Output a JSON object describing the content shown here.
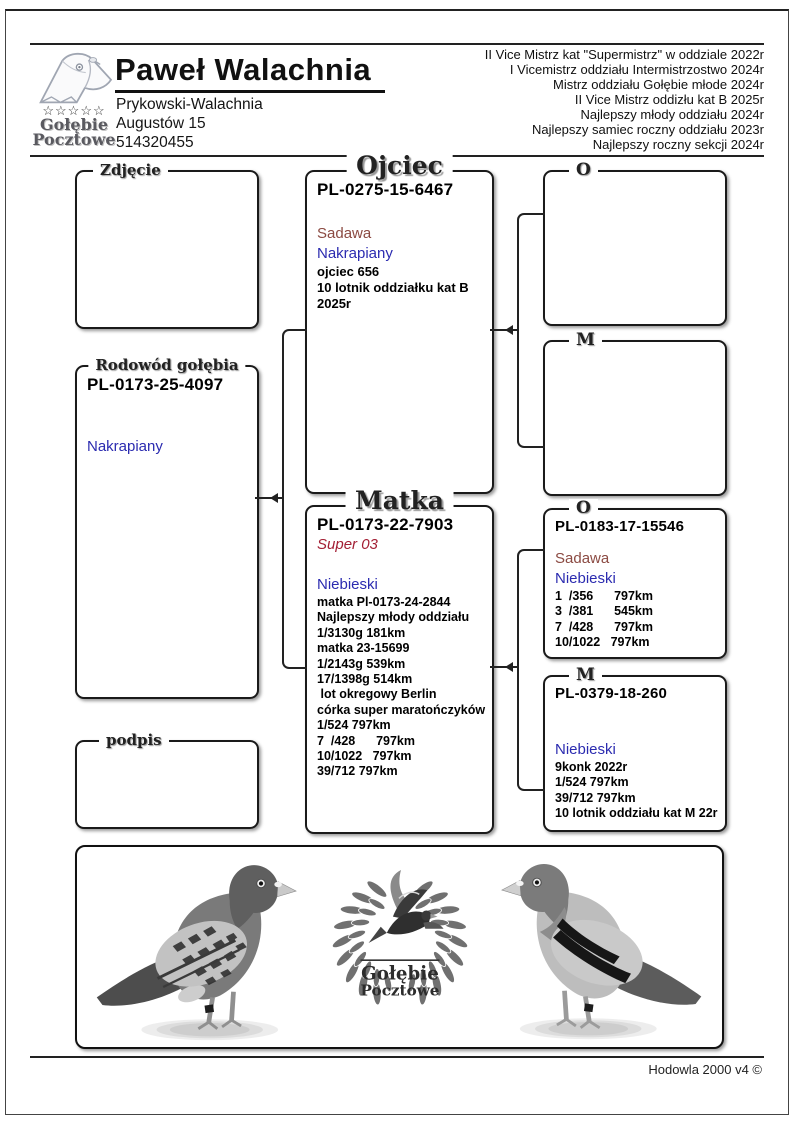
{
  "header": {
    "logo": {
      "icon": "pigeon-head-icon",
      "stars": "☆☆☆☆☆",
      "line1": "Gołębie",
      "line2": "Pocztowe"
    },
    "name": "Paweł Walachnia",
    "address_lines": [
      "Prykowski-Walachnia",
      "Augustów 15",
      "514320455"
    ],
    "achievements": [
      "II Vice Mistrz kat \"Supermistrz\" w oddziale 2022r",
      "I Vicemistrz oddziału Intermistrzostwo 2024r",
      "Mistrz oddziału Gołębie młode 2024r",
      "II Vice Mistrz oddizłu kat B 2025r",
      "Najlepszy młody oddziału 2024r",
      "Najlepszy samiec roczny oddziału 2023r",
      "Najlepszy roczny sekcji 2024r"
    ]
  },
  "pedigree": {
    "photo_box": {
      "legend": "Zdjęcie"
    },
    "main": {
      "legend": "Rodowód gołębia",
      "ring": "PL-0173-25-4097",
      "color": "Nakrapiany"
    },
    "signature_box": {
      "legend": "podpis"
    },
    "father": {
      "legend": "Ojciec",
      "ring": "PL-0275-15-6467",
      "strain": "Sadawa",
      "color": "Nakrapiany",
      "notes": [
        "ojciec 656",
        "10 lotnik oddziałku kat B",
        "2025r"
      ]
    },
    "mother": {
      "legend": "Matka",
      "ring": "PL-0173-22-7903",
      "name": "Super 03",
      "color": "Niebieski",
      "notes": [
        "matka Pl-0173-24-2844",
        "Najlepszy młody oddziału",
        "1/3130g 181km",
        "matka 23-15699",
        "1/2143g 539km",
        "17/1398g 514km",
        " lot okregowy Berlin",
        "córka super maratończyków",
        "1/524 797km",
        "7  /428      797km",
        "10/1022   797km",
        "39/712 797km"
      ]
    },
    "gp_father_father": {
      "legend": "O"
    },
    "gp_father_mother": {
      "legend": "M"
    },
    "gp_mother_father": {
      "legend": "O",
      "ring": "PL-0183-17-15546",
      "strain": "Sadawa",
      "color": "Niebieski",
      "notes": [
        "1  /356      797km",
        "3  /381      545km",
        "7  /428      797km",
        "10/1022   797km"
      ]
    },
    "gp_mother_mother": {
      "legend": "M",
      "ring": "PL-0379-18-260",
      "color": "Niebieski",
      "notes": [
        "9konk 2022r",
        "1/524 797km",
        "39/712 797km",
        "10 lotnik oddziału kat M 22r"
      ]
    }
  },
  "banner": {
    "wreath_line1": "Gołębie",
    "wreath_line2": "Pocztowe"
  },
  "footer": {
    "text": "Hodowla 2000 v4 ©"
  },
  "colors": {
    "strain_color": "#8B4A42",
    "blue_color": "#2B2BB0",
    "super_color": "#A31F34"
  }
}
